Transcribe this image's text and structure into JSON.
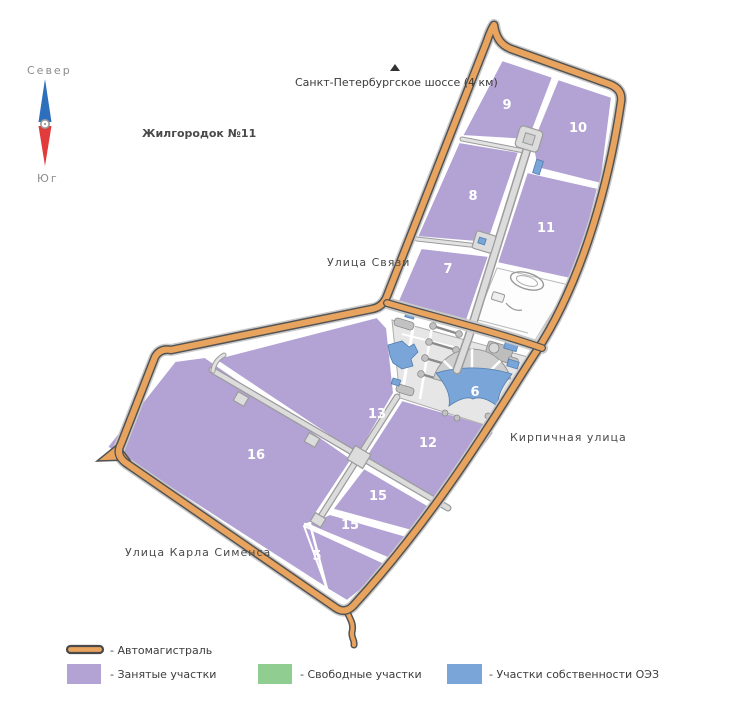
{
  "compass": {
    "north": "Север",
    "south": "Юг"
  },
  "labels": {
    "highway": "Санкт-Петербургское шоссе (4 км)",
    "district": "Жилгородок №11",
    "street_svyazi": "Улица Связи",
    "street_kirpichnaya": "Кирпичная улица",
    "street_simensa": "Улица Карла Сименса"
  },
  "plots": [
    {
      "number": "9"
    },
    {
      "number": "10"
    },
    {
      "number": "8"
    },
    {
      "number": "11"
    },
    {
      "number": "7"
    },
    {
      "number": "6"
    },
    {
      "number": "13"
    },
    {
      "number": "12"
    },
    {
      "number": "16"
    },
    {
      "number": "15"
    },
    {
      "number": "15"
    },
    {
      "number": "5"
    }
  ],
  "legend": {
    "items": [
      {
        "label": "- Автомагистраль",
        "type": "road"
      },
      {
        "label": "- Занятые участки",
        "type": "occupied"
      },
      {
        "label": "- Свободные участки",
        "type": "free"
      },
      {
        "label": "- Участки собственности ОЭЗ",
        "type": "oez"
      }
    ]
  },
  "colors": {
    "road": "#e8a45f",
    "occupied": "#b3a2d4",
    "free": "#90cd90",
    "oez": "#7aa5d8"
  }
}
